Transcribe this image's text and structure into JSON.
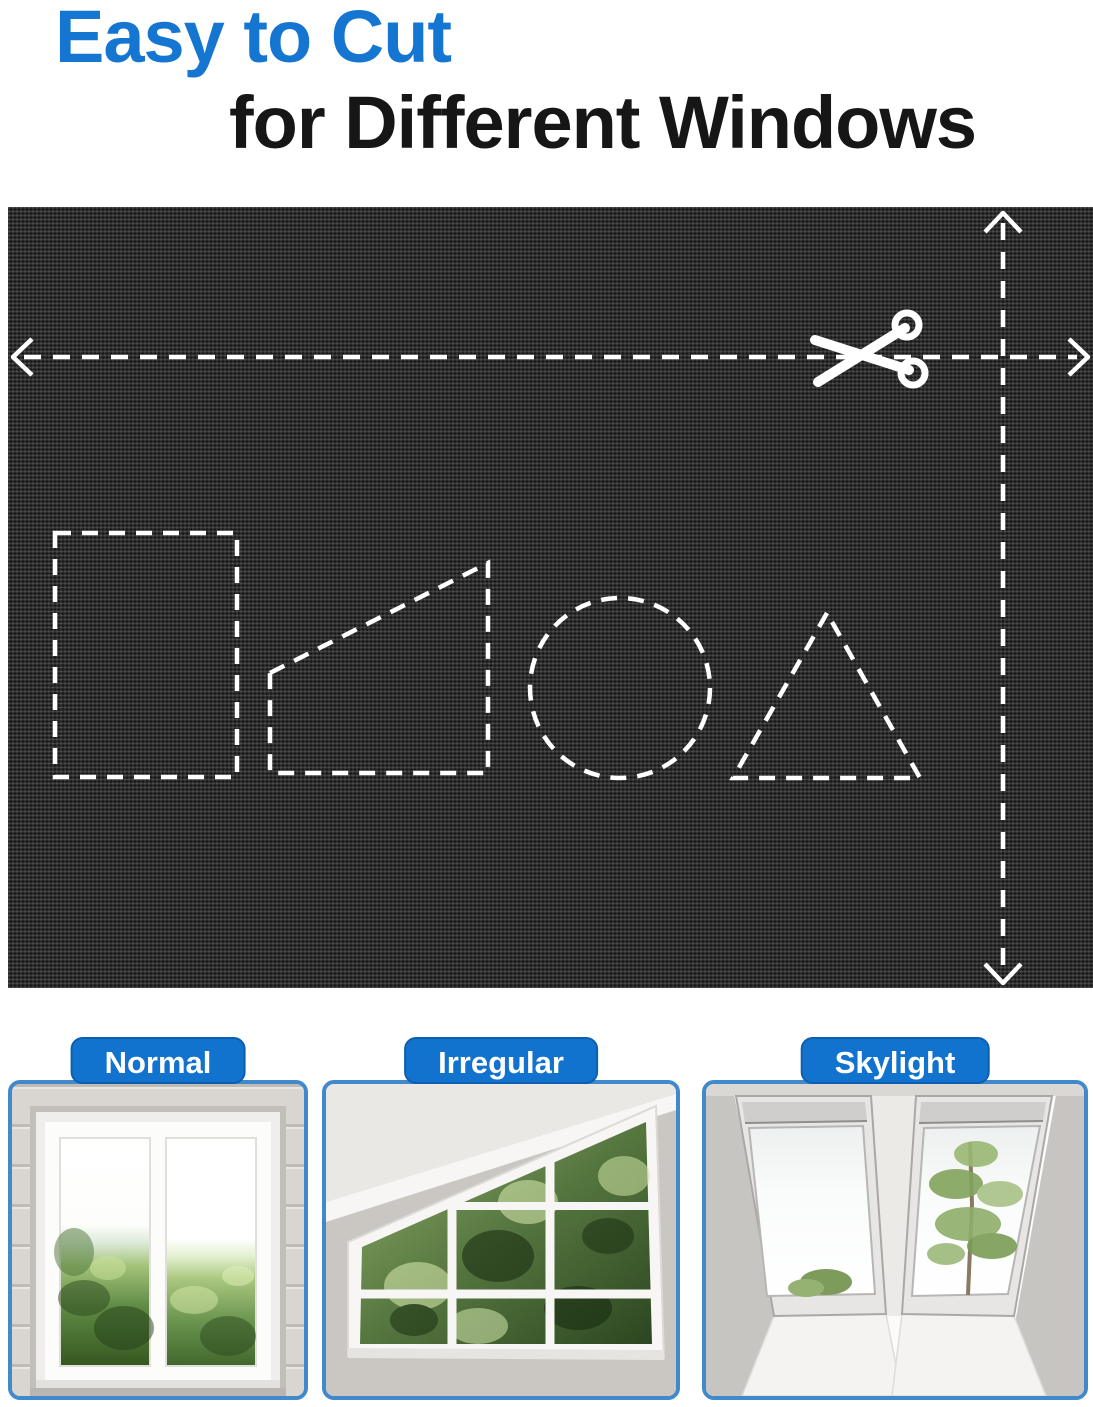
{
  "title": {
    "line1": "Easy to Cut",
    "line2": "for Different Windows"
  },
  "fabric_panel": {
    "icons": [
      "scissors-icon",
      "horizontal-cut-arrow",
      "vertical-cut-arrow"
    ],
    "cut_shapes": [
      "rectangle",
      "trapezoid",
      "circle",
      "triangle"
    ]
  },
  "cards": [
    {
      "label": "Normal"
    },
    {
      "label": "Irregular"
    },
    {
      "label": "Skylight"
    }
  ],
  "colors": {
    "title_blue": "#1576d2",
    "badge_blue": "#1273cf",
    "badge_border": "#0d5fae",
    "card_border": "#4189ca",
    "fabric_base": "#2d2c2c",
    "dash_white": "#ffffff"
  }
}
